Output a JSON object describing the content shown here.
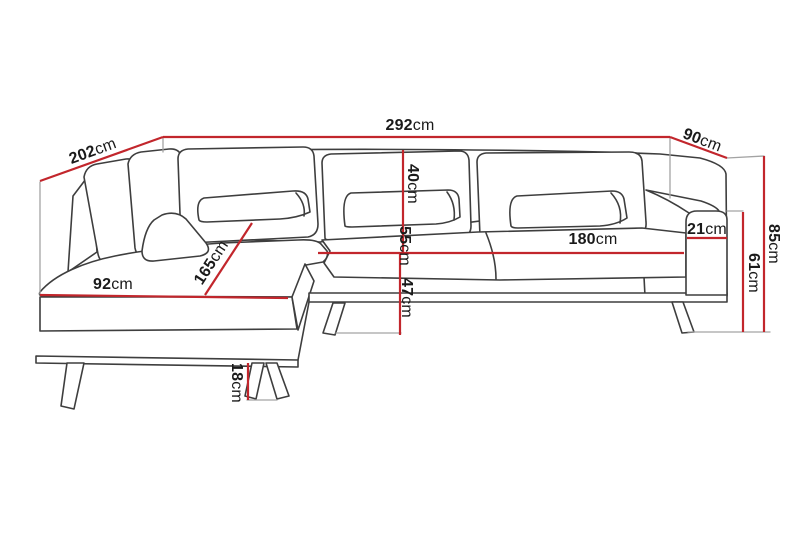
{
  "meta": {
    "type": "furniture-dimension-diagram",
    "subject": "corner chaise sofa technical line drawing",
    "unit": "cm"
  },
  "colors": {
    "dimension_red": "#c2262c",
    "line_dark": "#3e3e3e",
    "line_light": "#a3a3a3",
    "text": "#1a1a1a",
    "background": "#ffffff"
  },
  "dimensions": {
    "overall_width": {
      "value": "292",
      "unit": "cm"
    },
    "left_depth": {
      "value": "202",
      "unit": "cm"
    },
    "right_depth": {
      "value": "90",
      "unit": "cm"
    },
    "overall_height": {
      "value": "85",
      "unit": "cm"
    },
    "armrest_height": {
      "value": "61",
      "unit": "cm"
    },
    "armrest_width": {
      "value": "21",
      "unit": "cm"
    },
    "seat_width": {
      "value": "180",
      "unit": "cm"
    },
    "back_cushion_height": {
      "value": "40",
      "unit": "cm"
    },
    "backrest_height": {
      "value": "55",
      "unit": "cm"
    },
    "seat_height": {
      "value": "47",
      "unit": "cm"
    },
    "chaise_length": {
      "value": "165",
      "unit": "cm"
    },
    "chaise_width": {
      "value": "92",
      "unit": "cm"
    },
    "leg_height": {
      "value": "18",
      "unit": "cm"
    }
  }
}
